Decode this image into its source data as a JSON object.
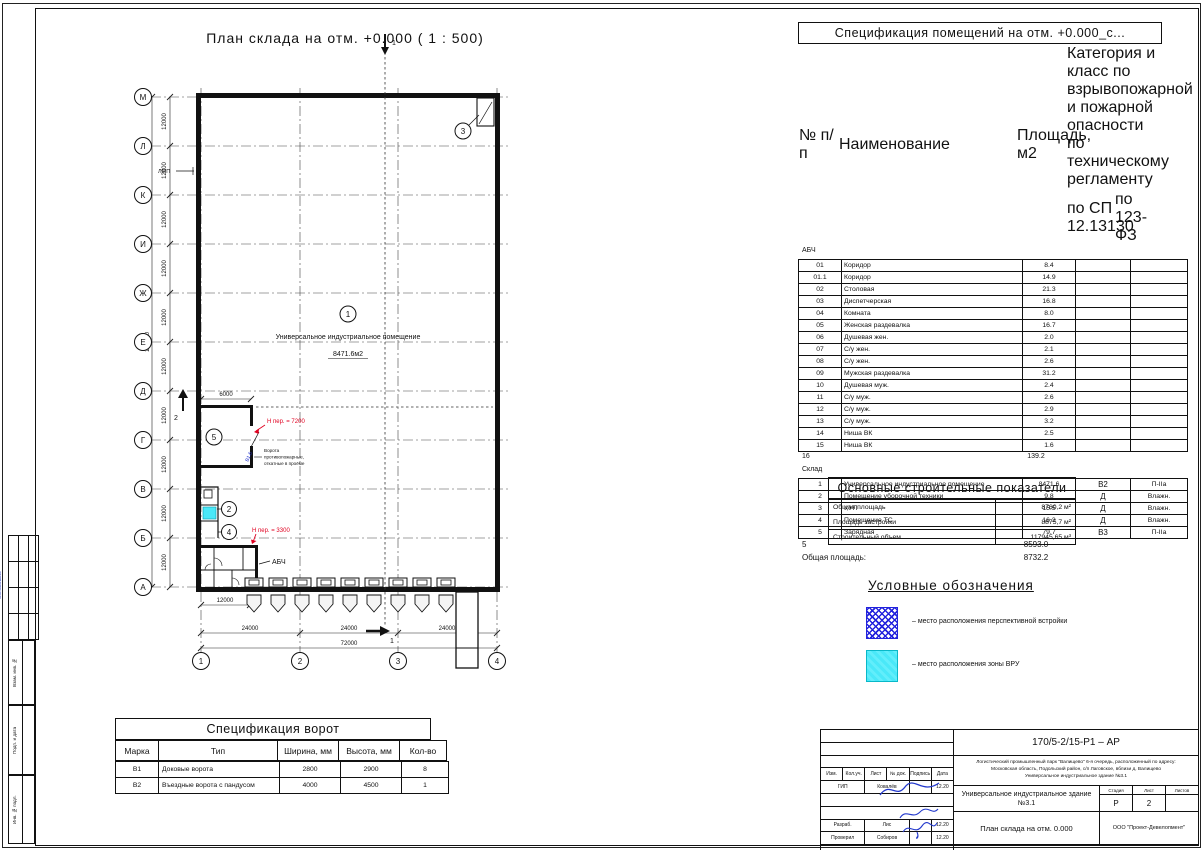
{
  "colors": {
    "accent_red": "#e00020",
    "ink_blue": "#2238cc",
    "legend_hatch_blue": "#2222dd",
    "legend_cyan": "#4ae8f8"
  },
  "plan": {
    "title": "План склада на отм. +0.000 ( 1 : 500)",
    "row_axes": [
      "М",
      "Л",
      "К",
      "И",
      "Ж",
      "Е",
      "Д",
      "Г",
      "В",
      "Б",
      "А"
    ],
    "col_axes": [
      "1",
      "2",
      "3",
      "4"
    ],
    "dims": {
      "bay_row": "12000",
      "row_total": "120000",
      "bay_col": "24000",
      "col_total": "72000",
      "abch_width": "12000",
      "room5_width": "6000"
    },
    "markers": {
      "m1": "1",
      "m2": "2",
      "m3": "3",
      "m4": "4",
      "m5": "5"
    },
    "sections": {
      "s1": "1",
      "s2": "2"
    },
    "room1_name": "Универсальное индустриальное помещение",
    "room1_area": "8471.6м2",
    "abch_label": "АБЧ",
    "note_lmp": "ЛМП",
    "note_h7200": "Н пер. = 7200",
    "note_h3300": "Н пер. = 3300",
    "fire_gate_l1": "Ворота",
    "fire_gate_l2": "противопожарные,",
    "fire_gate_l3": "откатные в проёме",
    "gate_mark": "В1.6"
  },
  "room_spec": {
    "title": "Спецификация помещений на отм. +0.000_с...",
    "h_num": "№ п/п",
    "h_name": "Наименование",
    "h_area": "Площадь, м2",
    "h_cat": "Категория и класс по взрывопожарной и пожарной опасности по техническому регламенту",
    "h_sp": "по СП 12.13130",
    "h_fz": "по 123-ФЗ",
    "group1_label": "АБЧ",
    "g1": [
      {
        "num": "01",
        "name": "Коридор",
        "area": "8.4"
      },
      {
        "num": "01.1",
        "name": "Коридор",
        "area": "14.9"
      },
      {
        "num": "02",
        "name": "Столовая",
        "area": "21.3"
      },
      {
        "num": "03",
        "name": "Диспетчерская",
        "area": "16.8"
      },
      {
        "num": "04",
        "name": "Комната",
        "area": "8.0"
      },
      {
        "num": "05",
        "name": "Женская раздевалка",
        "area": "16.7"
      },
      {
        "num": "06",
        "name": "Душевая жен.",
        "area": "2.0"
      },
      {
        "num": "07",
        "name": "С/у жен.",
        "area": "2.1"
      },
      {
        "num": "08",
        "name": "С/у жен.",
        "area": "2.6"
      },
      {
        "num": "09",
        "name": "Мужская раздевалка",
        "area": "31.2"
      },
      {
        "num": "10",
        "name": "Душевая муж.",
        "area": "2.4"
      },
      {
        "num": "11",
        "name": "С/у муж.",
        "area": "2.6"
      },
      {
        "num": "12",
        "name": "С/у муж.",
        "area": "2.9"
      },
      {
        "num": "13",
        "name": "С/у муж.",
        "area": "3.2"
      },
      {
        "num": "14",
        "name": "Ниша ВК",
        "area": "2.5"
      },
      {
        "num": "15",
        "name": "Ниша ВК",
        "area": "1.6"
      }
    ],
    "g1_total_count": "16",
    "g1_total_area": "139.2",
    "group2_label": "Склад",
    "g2": [
      {
        "num": "1",
        "name": "Универсальное индустриальное помещение",
        "area": "8471.6",
        "sp": "В2",
        "fz": "П-IIа"
      },
      {
        "num": "2",
        "name": "Помещение уборочной техники",
        "area": "9.8",
        "sp": "Д",
        "fz": "Влажн."
      },
      {
        "num": "3",
        "name": "УУП",
        "area": "15.5",
        "sp": "Д",
        "fz": "Влажн."
      },
      {
        "num": "4",
        "name": "Помещение ТС",
        "area": "16.3",
        "sp": "Д",
        "fz": "Влажн."
      },
      {
        "num": "5",
        "name": "Зарядная",
        "area": "79.7",
        "sp": "В3",
        "fz": "П-IIа"
      }
    ],
    "g2_total_count": "5",
    "g2_total_area": "8593.0",
    "total_label": "Общая площадь:",
    "total_area": "8732.2"
  },
  "indicators": {
    "title": "Основные строительные показатели",
    "rows": [
      {
        "label": "Общая площадь",
        "value": "8760,2 м²"
      },
      {
        "label": "Площадь застройки",
        "value": "8875,7 м²"
      },
      {
        "label": "Строительный объем",
        "value": "117945,65 м³"
      }
    ]
  },
  "legend": {
    "title": "Условные обозначения",
    "item1": "– место расположения перспективной встройки",
    "item2": "– место расположения зоны ВРУ"
  },
  "gate_spec": {
    "title": "Спецификация ворот",
    "headers": {
      "mark": "Марка",
      "type": "Тип",
      "width": "Ширина, мм",
      "height": "Высота, мм",
      "qty": "Кол-во"
    },
    "rows": [
      {
        "mark": "В1",
        "type": "Доковые ворота",
        "width": "2800",
        "height": "2900",
        "qty": "8"
      },
      {
        "mark": "В2",
        "type": "Въездные ворота с пандусом",
        "width": "4000",
        "height": "4500",
        "qty": "1"
      }
    ]
  },
  "title_block": {
    "doc_number": "170/5-2/15-Р1 – АР",
    "desc_l1": "Логистический промышленный парк \"Валищево\" 6-я очередь, расположенный по адресу:",
    "desc_l2": "Московская область, Подольский район, с/п Лаговское, вблизи д. Валищево",
    "desc_l3": "Универсальное индустриальное здание №3.1",
    "head": {
      "izm": "Изм.",
      "kol": "Кол.уч.",
      "list": "Лист",
      "doc": "№ док.",
      "sign": "Подпись",
      "date": "Дата"
    },
    "gip_role": "ГИП",
    "gip_name": "Ковалёв",
    "gip_date": "12.20",
    "dev_role": "Разраб.",
    "dev_name": "Лис",
    "dev_date": "12.20",
    "check_role": "Проверил",
    "check_name": "Собиров",
    "check_date": "12.20",
    "object_name": "Универсальное индустриальное здание №3.1",
    "stage_label": "Стадия",
    "sheet_label": "Лист",
    "sheets_label": "Листов",
    "stage": "Р",
    "sheet_num": "2",
    "sheets_total": "",
    "drawing_name": "План склада на отм. 0.000",
    "company": "ООО \"Проект-Девелопмент\""
  },
  "frame": {
    "approved": "Согласовано",
    "vzam": "Взам. инв. №",
    "podp": "Подп. и дата",
    "inv": "Инв. № подл."
  }
}
